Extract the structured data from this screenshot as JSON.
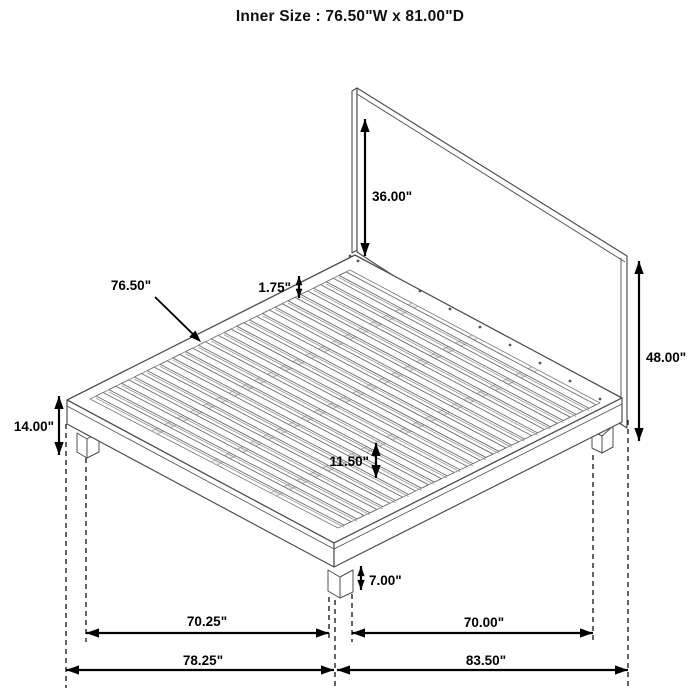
{
  "title": "Inner Size : 76.50\"W x 81.00\"D",
  "product": {
    "type": "platform-bed-with-headboard-dimension-diagram",
    "dimension_labels": [
      "36.00\"",
      "76.50\"",
      "1.75\"",
      "48.00\"",
      "14.00\"",
      "11.50\"",
      "7.00\"",
      "70.25\"",
      "70.00\"",
      "78.25\"",
      "83.50\""
    ]
  },
  "drawing": {
    "colors": {
      "structure": "#4f4f4f",
      "slat": "#6e6e6e",
      "slat_shadow": "#8a8a8a",
      "brace_fill": "#ececec",
      "brace_stroke": "#999999",
      "dimension": "#000000",
      "dashed": "#222222",
      "background": "#ffffff"
    },
    "headboard": {
      "left_edge": [
        [
          352,
          91
        ],
        [
          357,
          88
        ],
        [
          357,
          250
        ],
        [
          352,
          253
        ]
      ],
      "face": [
        [
          357,
          88
        ],
        [
          627,
          256
        ],
        [
          627,
          428
        ],
        [
          357,
          252
        ]
      ],
      "top_inner": [
        357,
        94,
        625,
        262
      ],
      "right_inner": [
        621,
        258,
        621,
        425
      ]
    },
    "deck": {
      "outer": [
        [
          355,
          255
        ],
        [
          622,
          398
        ],
        [
          334,
          543
        ],
        [
          67,
          400
        ]
      ],
      "inner": [
        [
          350,
          270
        ],
        [
          600,
          403
        ],
        [
          338,
          528
        ],
        [
          90,
          399
        ]
      ],
      "foot_face": [
        [
          67,
          400
        ],
        [
          334,
          543
        ],
        [
          334,
          567
        ],
        [
          67,
          424
        ]
      ],
      "right_face": [
        [
          334,
          543
        ],
        [
          622,
          398
        ],
        [
          622,
          422
        ],
        [
          334,
          567
        ]
      ],
      "foot_line": [
        67,
        406,
        334,
        549
      ],
      "right_line": [
        334,
        549,
        622,
        404
      ]
    },
    "slats": {
      "count": 20,
      "t_start": 0.015,
      "pitch": 0.0492,
      "width": 0.027
    },
    "braces": {
      "fractions": [
        0.26,
        0.5,
        0.74
      ],
      "half_width": 0.012
    },
    "screws": [
      [
        420,
        291
      ],
      [
        450,
        309
      ],
      [
        480,
        327
      ],
      [
        510,
        345
      ],
      [
        540,
        363
      ],
      [
        570,
        381
      ],
      [
        600,
        399
      ]
    ],
    "bracket_dots": [
      [
        350,
        256
      ],
      [
        358,
        261
      ]
    ],
    "legs": [
      [
        [
          [
            77,
            433
          ],
          [
            77,
            452
          ],
          [
            87,
            458
          ],
          [
            87,
            439
          ]
        ],
        [
          [
            87,
            439
          ],
          [
            87,
            458
          ],
          [
            99,
            452
          ],
          [
            99,
            431
          ]
        ]
      ],
      [
        [
          [
            328,
            570
          ],
          [
            328,
            591
          ],
          [
            340,
            598
          ],
          [
            340,
            577
          ]
        ],
        [
          [
            340,
            577
          ],
          [
            340,
            598
          ],
          [
            353,
            592
          ],
          [
            353,
            570
          ]
        ]
      ],
      [
        [
          [
            592,
            431
          ],
          [
            592,
            448
          ],
          [
            602,
            453
          ],
          [
            602,
            436
          ]
        ],
        [
          [
            602,
            436
          ],
          [
            602,
            453
          ],
          [
            613,
            447
          ],
          [
            613,
            426
          ]
        ]
      ]
    ],
    "dashed_lines": [
      [
        66,
        424,
        688
      ],
      [
        86,
        458,
        642
      ],
      [
        329,
        597,
        642
      ],
      [
        335,
        600,
        688
      ],
      [
        352,
        594,
        642
      ],
      [
        593,
        455,
        642
      ],
      [
        628,
        420,
        688
      ]
    ],
    "dims_vertical": [
      {
        "id": "headboard-panel-height",
        "label": "36.00\"",
        "x": 365,
        "y1": 119,
        "y2": 256,
        "lx": 372,
        "ly": 201,
        "anchor": "start"
      },
      {
        "id": "headboard-total-height",
        "label": "48.00\"",
        "x": 639,
        "y1": 261,
        "y2": 441,
        "lx": 646,
        "ly": 362,
        "anchor": "start"
      },
      {
        "id": "platform-height",
        "label": "14.00\"",
        "x": 59,
        "y1": 396,
        "y2": 455,
        "lx": 54,
        "ly": 431,
        "anchor": "end"
      },
      {
        "id": "slat-spacing",
        "label": "1.75\"",
        "x": 299,
        "y1": 276,
        "y2": 298,
        "lx": 291,
        "ly": 292,
        "anchor": "end"
      },
      {
        "id": "under-bed-clearance",
        "label": "11.50\"",
        "x": 376,
        "y1": 443,
        "y2": 478,
        "lx": 369,
        "ly": 466,
        "anchor": "end"
      },
      {
        "id": "leg-height",
        "label": "7.00\"",
        "x": 361,
        "y1": 566,
        "y2": 590,
        "lx": 369,
        "ly": 585,
        "anchor": "start"
      }
    ],
    "dims_horizontal": [
      {
        "id": "front-width",
        "label": "70.25\"",
        "y": 633,
        "x1": 86,
        "x2": 329,
        "lx": 207,
        "ly": 626
      },
      {
        "id": "side-depth",
        "label": "70.00\"",
        "y": 633,
        "x1": 352,
        "x2": 593,
        "lx": 484,
        "ly": 627
      },
      {
        "id": "overall-width",
        "label": "78.25\"",
        "y": 670,
        "x1": 66,
        "x2": 334,
        "lx": 203,
        "ly": 665
      },
      {
        "id": "overall-depth",
        "label": "83.50\"",
        "y": 670,
        "x1": 337,
        "x2": 628,
        "lx": 486,
        "ly": 665
      }
    ],
    "leader": {
      "id": "slat-width",
      "label": "76.50\"",
      "x1": 155,
      "y1": 297,
      "x2": 201,
      "y2": 342,
      "lx": 131,
      "ly": 290
    }
  }
}
